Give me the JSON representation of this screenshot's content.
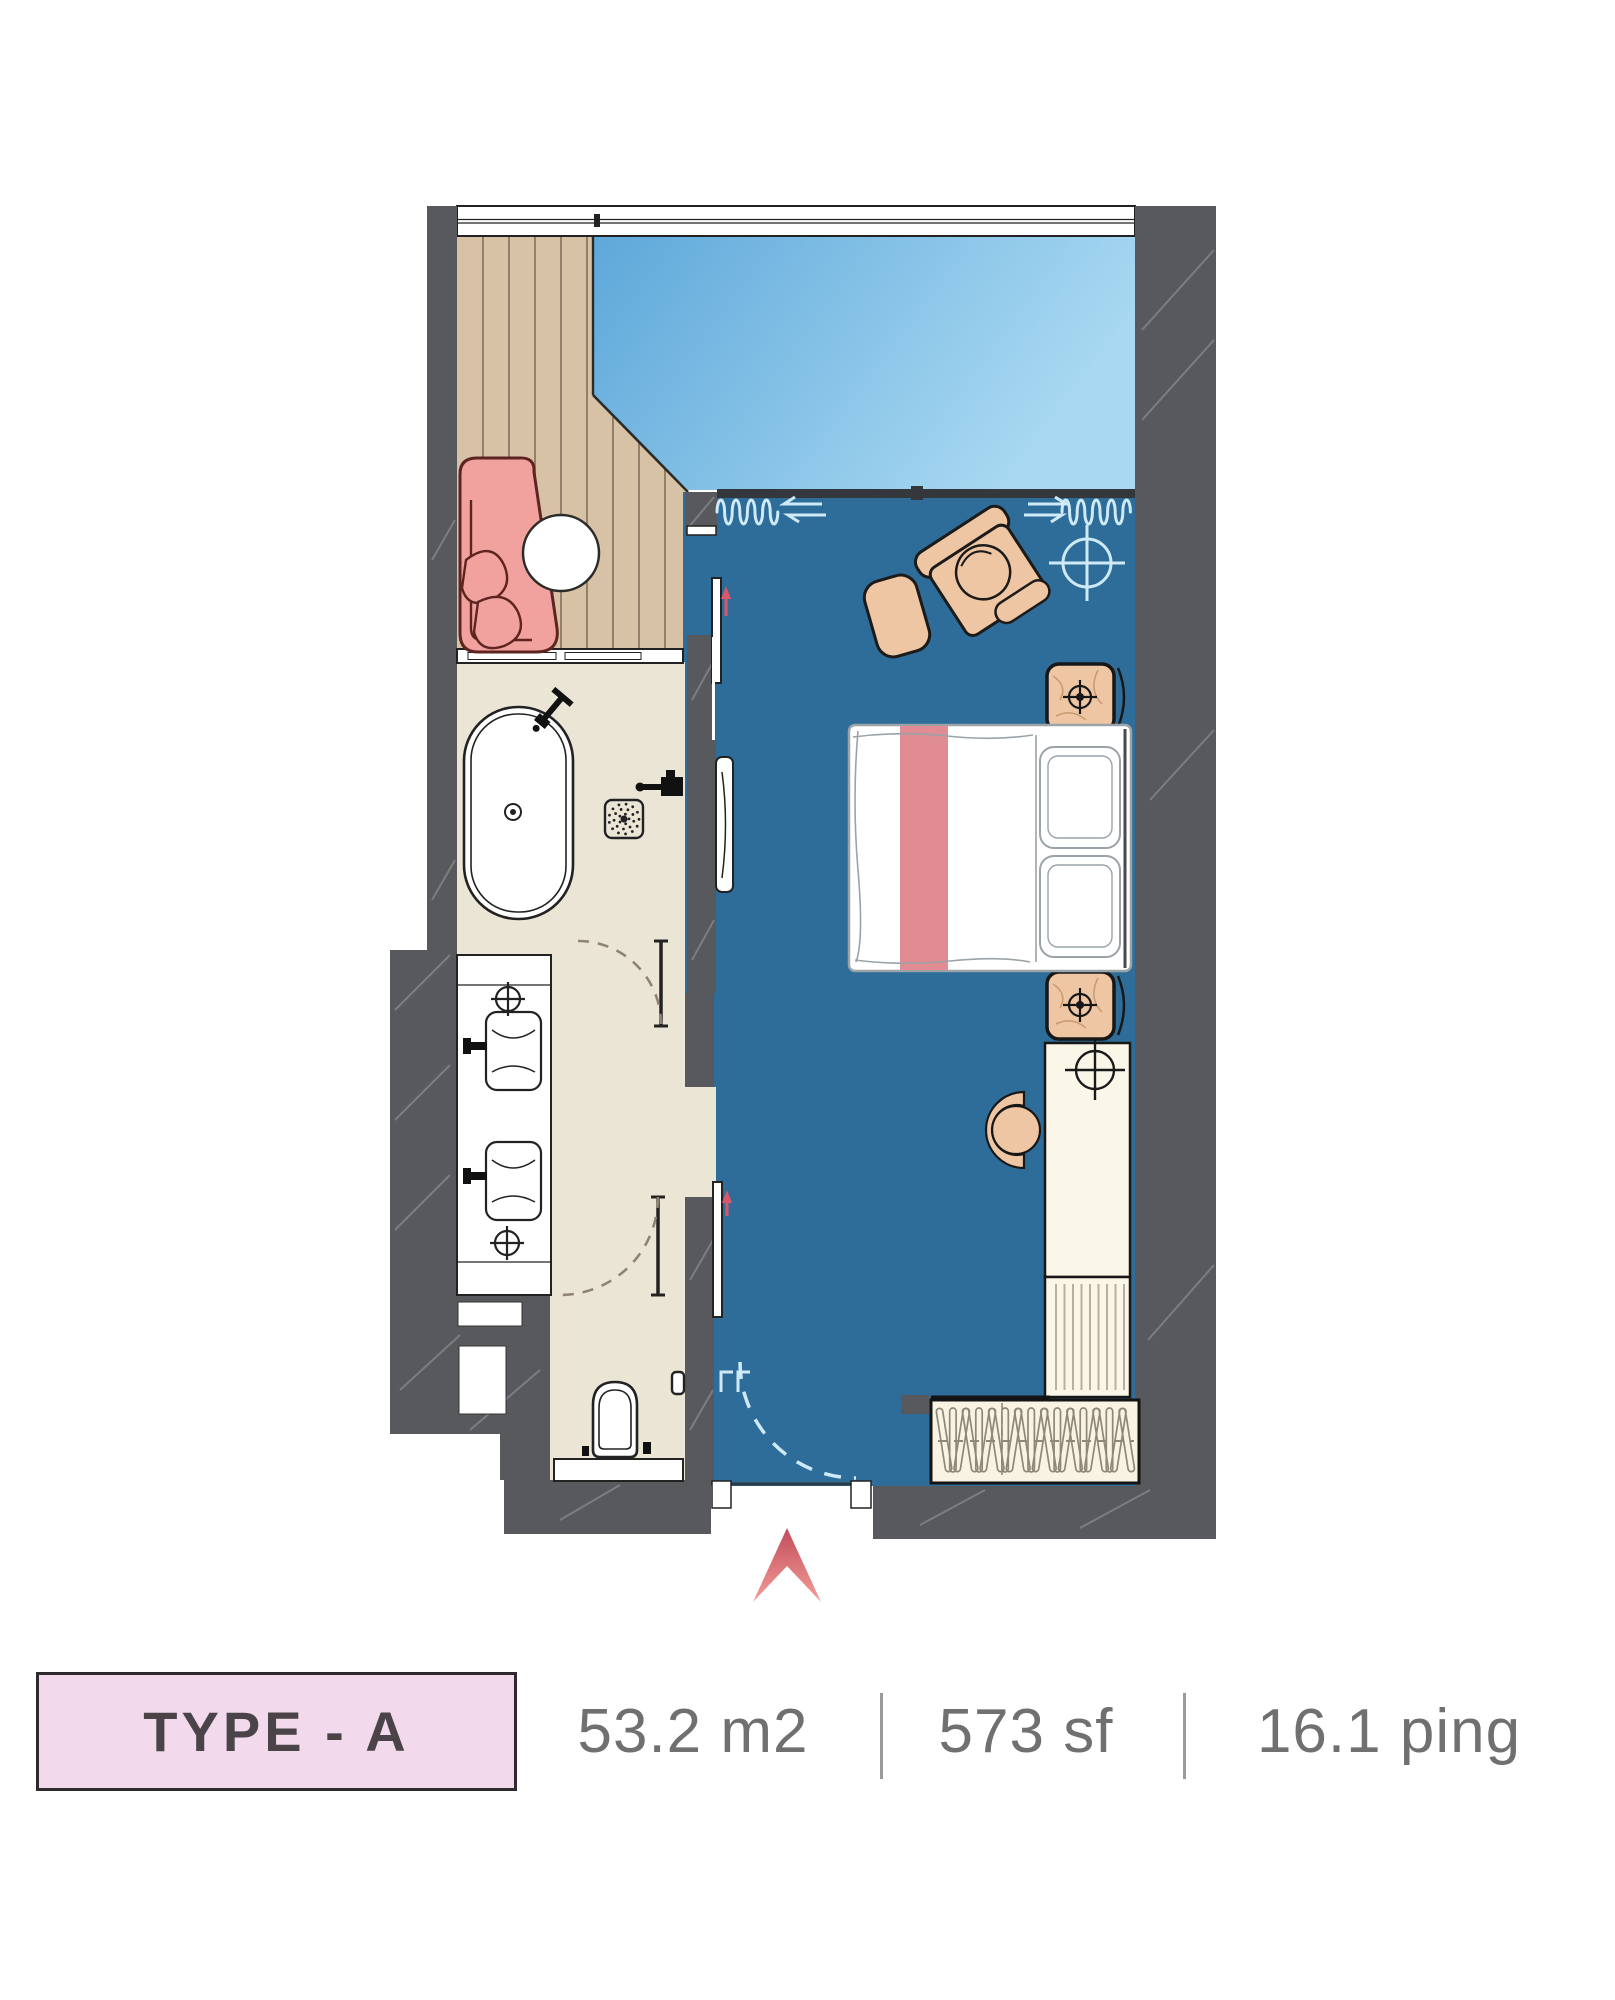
{
  "label": {
    "type": "TYPE - A"
  },
  "metrics": {
    "m2": "53.2 m2",
    "sf": "573 sf",
    "ping": "16.1 ping"
  },
  "colors": {
    "wall": "#58595c",
    "wallHatch": "#7b7d80",
    "roomBlue": "#2e6d99",
    "glassLight": "#a9d9f2",
    "glassDark": "#5ea8da",
    "deck": "#d8c2a6",
    "deckSeam": "#7e6f5d",
    "bath": "#ebe5d6",
    "cream": "#fbf7e8",
    "tan": "#eec6a4",
    "outline": "#1c1b19",
    "pinkChair": "#f2a29e",
    "pinkOutline": "#5d2420",
    "bedLine": "#9aa3a8",
    "bedStripe": "#e18b92",
    "paleBlue": "#cfeaf7",
    "accentRed": "#d9566b",
    "labelPink": "#f3d9ec",
    "labelText": "#4a4449",
    "metaText": "#707070",
    "hanger": "#8f887a",
    "corridorDash": "#8e8374",
    "north1": "#c24c5c",
    "north2": "#f49d97"
  },
  "icons": [
    "north-arrow-icon",
    "ceiling-light-crosshair-icon",
    "faucet-crosshair-icon",
    "floor-drain-icon",
    "curtain-icon",
    "door-swing-icon",
    "hanger-icon",
    "tv-panel-icon",
    "sliding-door-icon"
  ]
}
